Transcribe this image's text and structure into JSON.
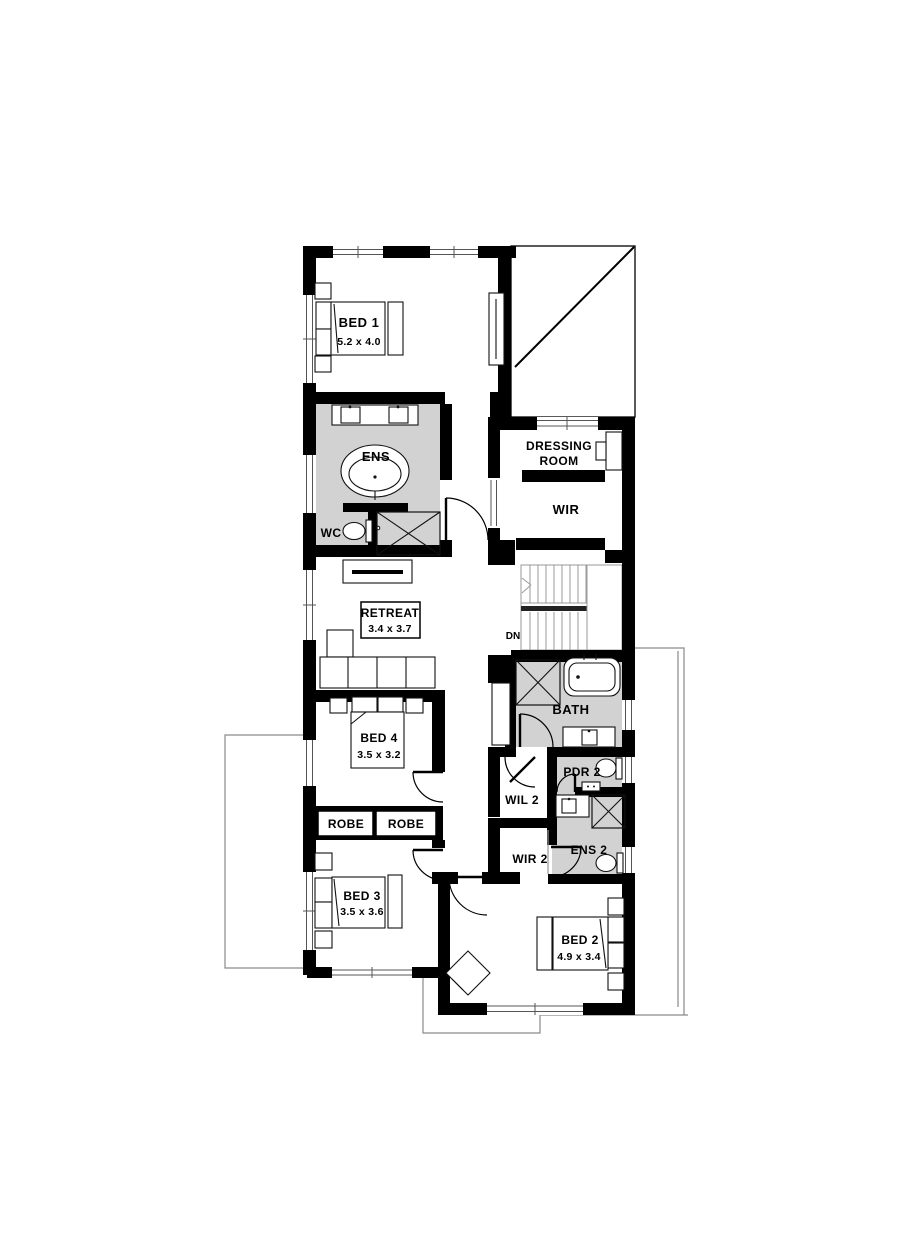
{
  "plan": {
    "rooms": {
      "bed1": {
        "name": "BED 1",
        "dims": "5.2 x 4.0"
      },
      "ens": {
        "name": "ENS"
      },
      "wc": {
        "name": "WC"
      },
      "dressing": {
        "line1": "DRESSING",
        "line2": "ROOM"
      },
      "wir": {
        "name": "WIR"
      },
      "retreat": {
        "name": "RETREAT",
        "dims": "3.4 x 3.7"
      },
      "stairs": {
        "down_label": "DN"
      },
      "bath": {
        "name": "BATH"
      },
      "bed4": {
        "name": "BED 4",
        "dims": "3.5 x 3.2"
      },
      "robe_left": {
        "name": "ROBE"
      },
      "robe_right": {
        "name": "ROBE"
      },
      "wil2": {
        "name": "WIL 2"
      },
      "wir2": {
        "name": "WIR 2"
      },
      "pdr2": {
        "name": "PDR 2"
      },
      "ens2": {
        "name": "ENS 2"
      },
      "bed3": {
        "name": "BED 3",
        "dims": "3.5 x 3.6"
      },
      "bed2": {
        "name": "BED 2",
        "dims": "4.9 x 3.4"
      }
    },
    "colors": {
      "wall": "#000000",
      "wet_area_fill": "#d2d2d2",
      "outline": "#8a8a8a"
    }
  }
}
